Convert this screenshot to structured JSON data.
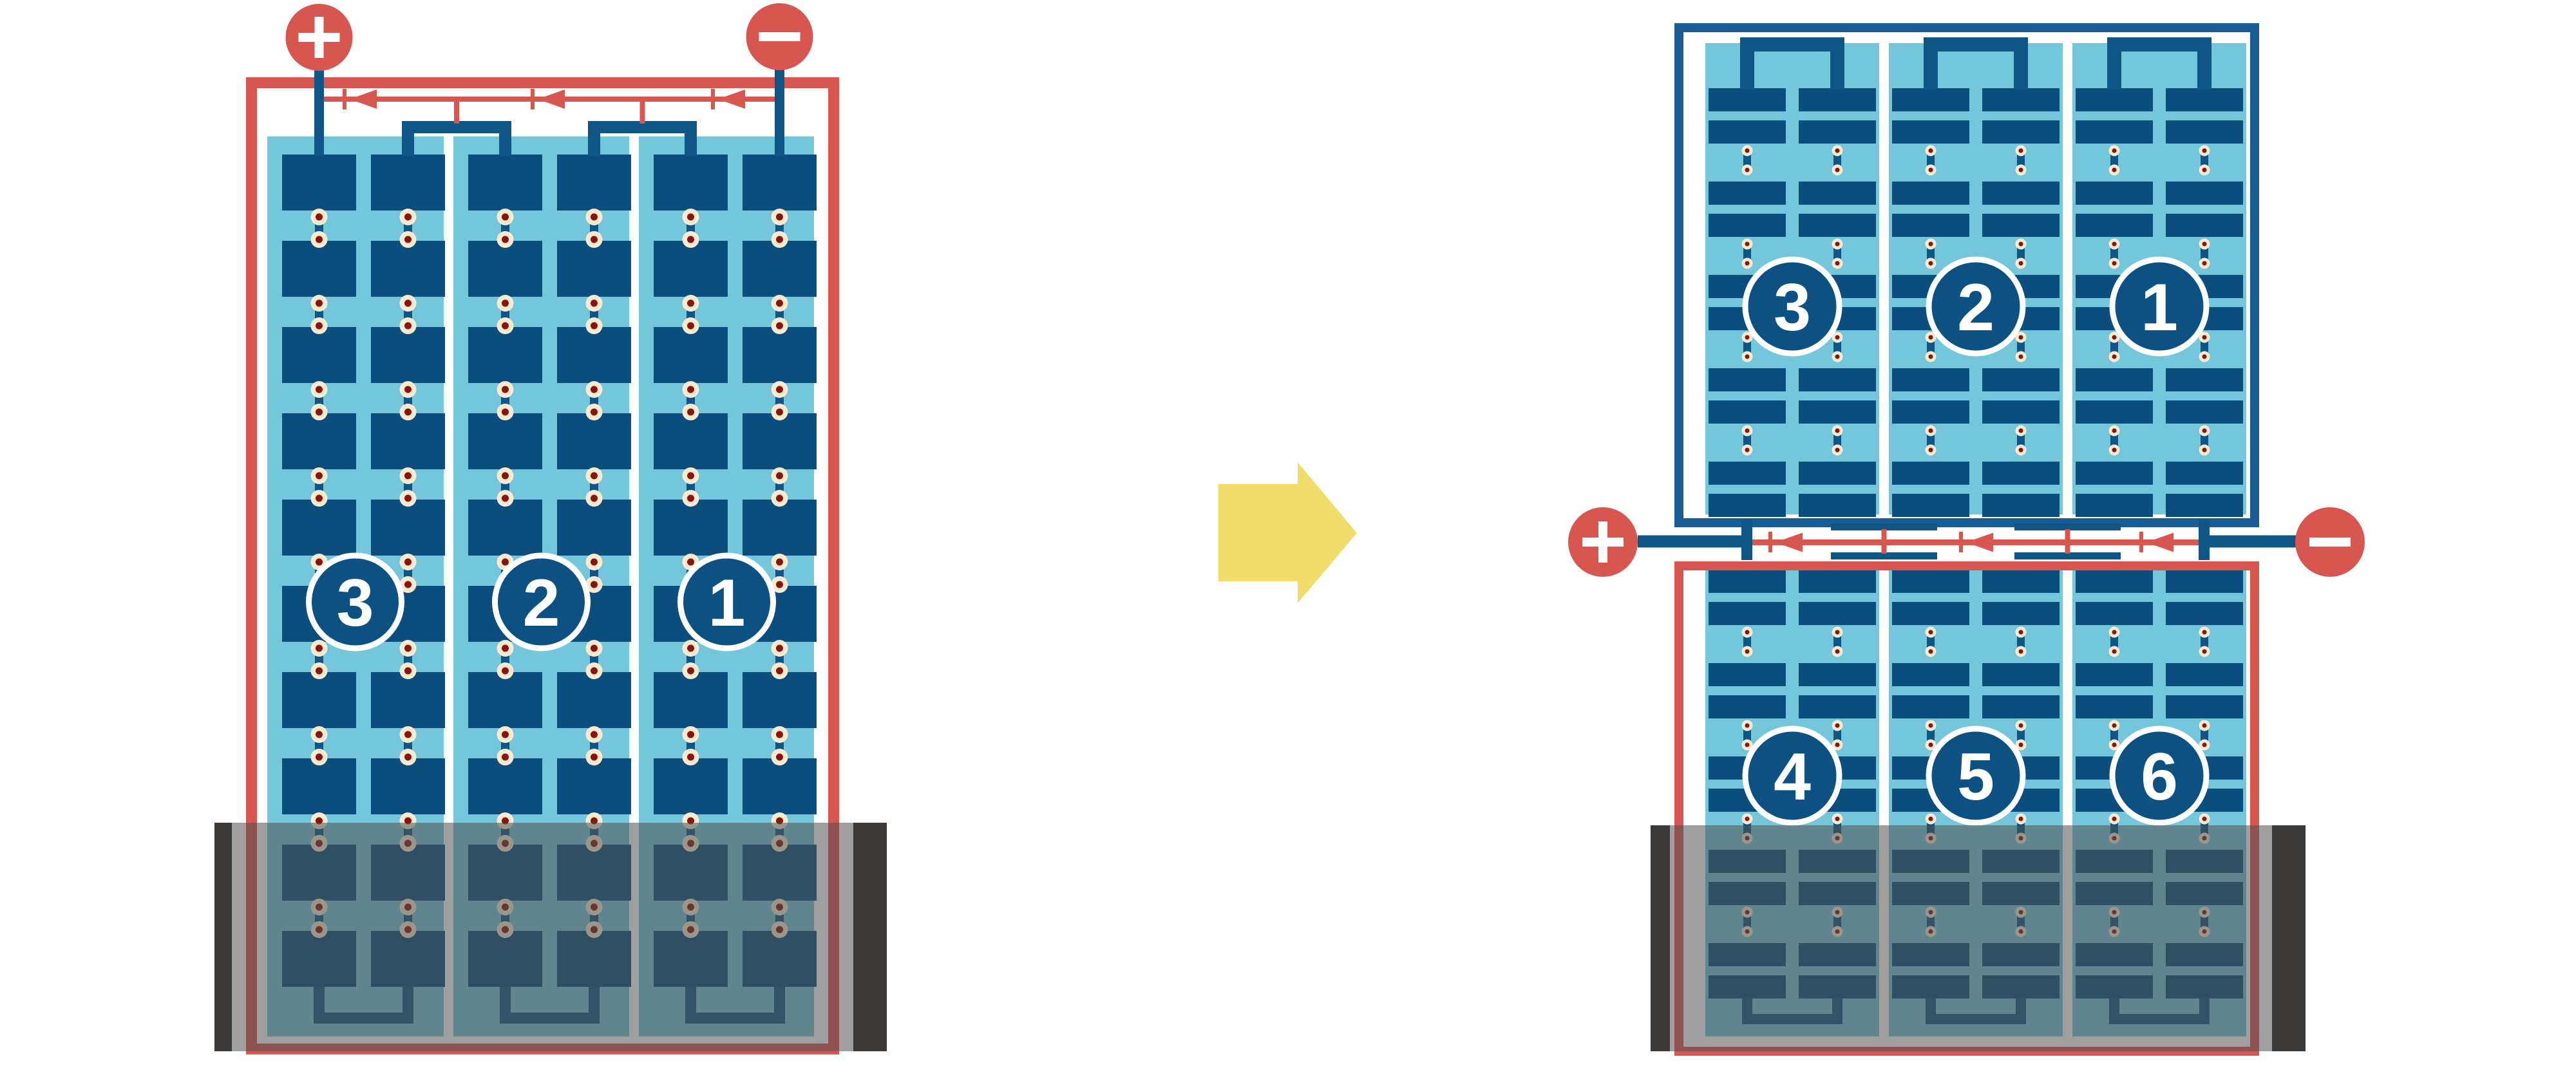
{
  "left_module": {
    "positive_terminal_symbol": "+",
    "negative_terminal_symbol": "−",
    "string_labels": [
      "3",
      "2",
      "1"
    ],
    "bypass_diode_count": 3
  },
  "arrow": {
    "direction": "right"
  },
  "right_module": {
    "positive_terminal_symbol": "+",
    "negative_terminal_symbol": "−",
    "top_string_labels": [
      "3",
      "2",
      "1"
    ],
    "bottom_string_labels": [
      "4",
      "5",
      "6"
    ],
    "bypass_diode_count": 3
  },
  "colors": {
    "red": "#D7564F",
    "panel_blue": "#74C6DB",
    "cell_blue": "#0B4D7C",
    "bus_blue": "#0F5585",
    "frame_blue": "#1A5C94",
    "circle_blue": "#0D5183",
    "dot_cream": "#F6EAD1",
    "dot_red": "#8B130A",
    "arrow_yellow": "#F1DD6B",
    "shade_gray": "rgba(80,80,80,0.55)",
    "bar_black": "#3B3938",
    "background": "#FFFFFF"
  }
}
